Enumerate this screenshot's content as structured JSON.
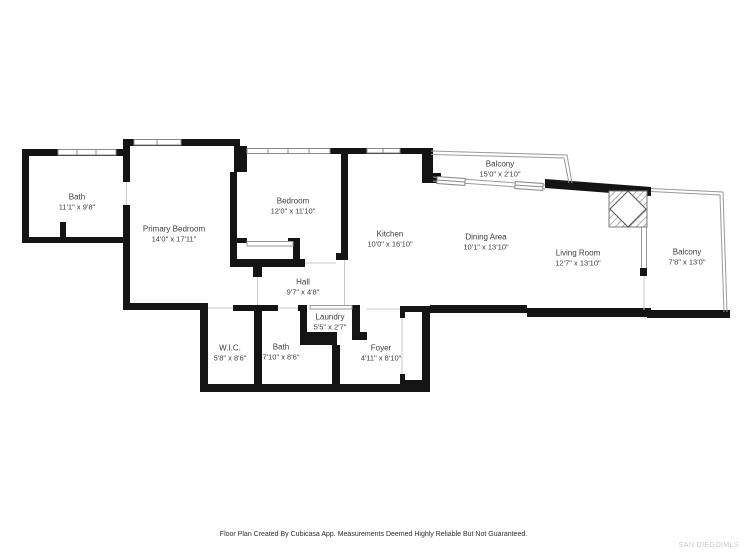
{
  "rooms": [
    {
      "id": "bath-upper",
      "name": "Bath",
      "dims": "11'1\" x 9'8\""
    },
    {
      "id": "primary-bedroom",
      "name": "Primary Bedroom",
      "dims": "14'0\" x 17'11\""
    },
    {
      "id": "bedroom",
      "name": "Bedroom",
      "dims": "12'0\" x 11'10\""
    },
    {
      "id": "kitchen",
      "name": "Kitchen",
      "dims": "10'0\" x 16'10\""
    },
    {
      "id": "dining-area",
      "name": "Dining Area",
      "dims": "10'1\" x 13'10\""
    },
    {
      "id": "living-room",
      "name": "Living Room",
      "dims": "12'7\" x 13'10\""
    },
    {
      "id": "balcony-top",
      "name": "Balcony",
      "dims": "15'0\" x 2'10\""
    },
    {
      "id": "balcony-right",
      "name": "Balcony",
      "dims": "7'8\" x 13'0\""
    },
    {
      "id": "hall",
      "name": "Hall",
      "dims": "9'7\" x 4'8\""
    },
    {
      "id": "wic",
      "name": "W.I.C.",
      "dims": "5'8\" x 8'6\""
    },
    {
      "id": "bath-lower",
      "name": "Bath",
      "dims": "7'10\" x 8'6\""
    },
    {
      "id": "laundry",
      "name": "Laundry",
      "dims": "5'5\" x 2'7\""
    },
    {
      "id": "foyer",
      "name": "Foyer",
      "dims": "4'11\" x 8'10\""
    }
  ],
  "footer": {
    "disclaimer": "Floor Plan Created By Cubicasa App. Measurements Deemed Highly Reliable But Not Guaranteed.",
    "logo": "SAN DIEGO|MLS"
  },
  "colors": {
    "wall": "#141414",
    "background": "#ffffff",
    "label_text": "#3d3d3d",
    "railing": "#9a9a9a",
    "window_border": "#8a8a8a",
    "opening_line": "#c9c9c9",
    "footer_text": "#2b2b2b",
    "logo_text": "#c8c8c8"
  }
}
